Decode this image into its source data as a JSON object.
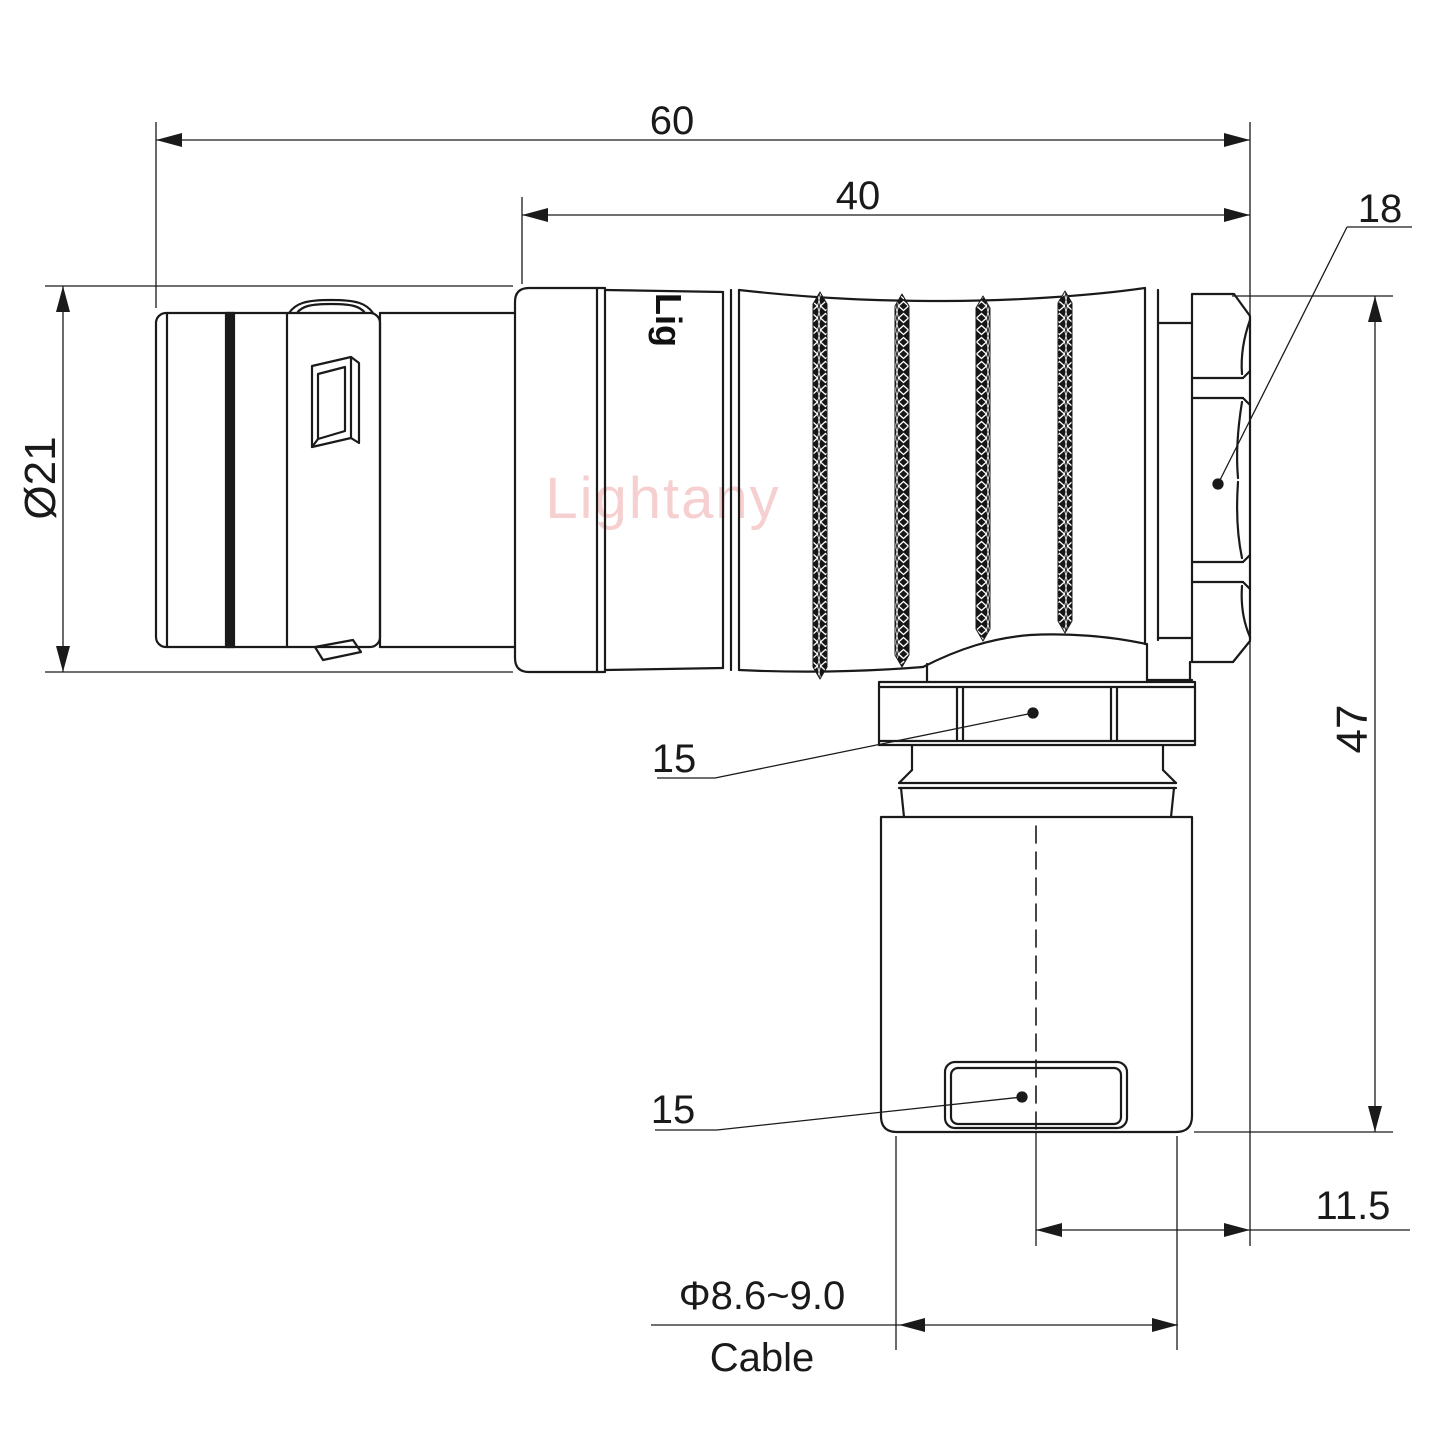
{
  "drawing": {
    "title_visible_text": "",
    "watermark": "Lightany",
    "body_print": "Lig",
    "colors": {
      "line": "#1a1a1a",
      "watermark": "#f6d0d0",
      "background": "#ffffff"
    },
    "dimensions": {
      "overall_length": "60",
      "rear_length": "40",
      "backnut_size": "18",
      "front_diameter": "Ø21",
      "height": "47",
      "coupling_nut_size": "15",
      "clamp_nut_size": "15",
      "center_offset": "11.5",
      "cable_diameter": "Φ8.6~9.0",
      "cable_label": "Cable"
    }
  }
}
